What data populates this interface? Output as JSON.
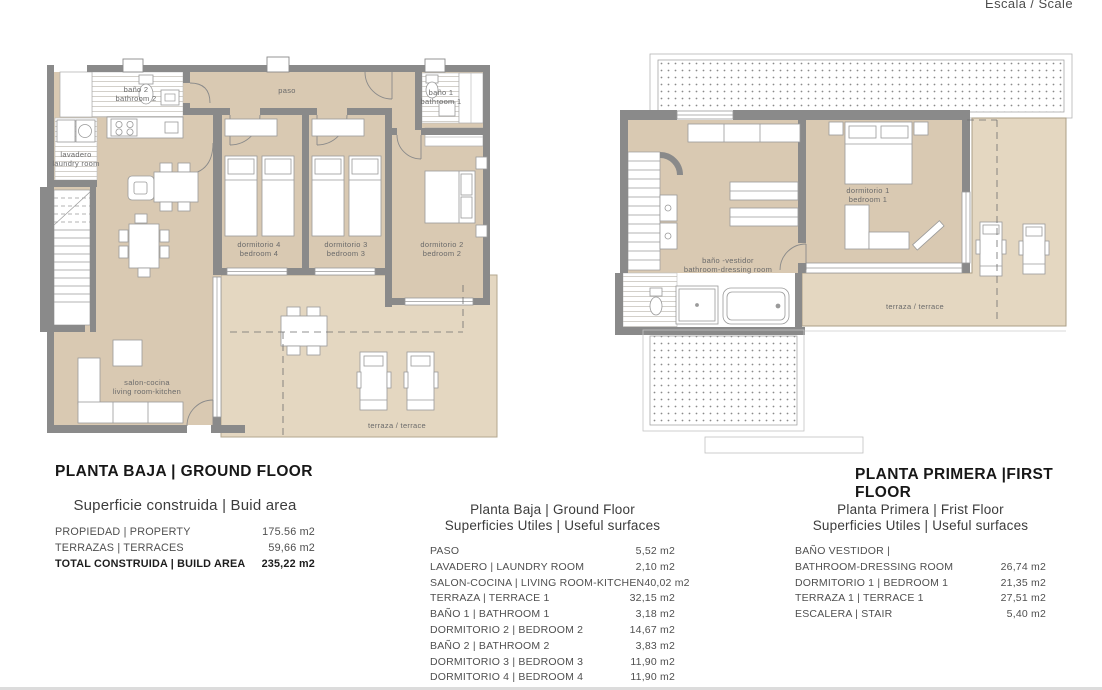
{
  "scale_note": "Escala / Scale",
  "colors": {
    "wall": "#8a8a8a",
    "floor": "#d9c9b2",
    "terrace": "#e4d7c1"
  },
  "plans": {
    "ground": {
      "title": "PLANTA BAJA | GROUND FLOOR",
      "labels": {
        "bano2_1": "baño 2",
        "bano2_2": "bathroom 2",
        "lavadero_1": "lavadero",
        "lavadero_2": "laundry room",
        "paso": "paso",
        "bano1_1": "baño 1",
        "bano1_2": "bathroom 1",
        "dorm4_1": "dormitorio 4",
        "dorm4_2": "bedroom 4",
        "dorm3_1": "dormitorio 3",
        "dorm3_2": "bedroom 3",
        "dorm2_1": "dormitorio 2",
        "dorm2_2": "bedroom 2",
        "salon_1": "salon-cocina",
        "salon_2": "living room-kitchen",
        "terraza": "terraza / terrace"
      }
    },
    "first": {
      "title": "PLANTA PRIMERA |FIRST FLOOR",
      "labels": {
        "banov_1": "baño -vestidor",
        "banov_2": "bathroom-dressing room",
        "dorm1_1": "dormitorio 1",
        "dorm1_2": "bedroom 1",
        "terraza": "terraza / terrace"
      }
    }
  },
  "tables": {
    "area": {
      "title": "Superficie construida | Buid area",
      "rows": [
        {
          "label": "PROPIEDAD | PROPERTY",
          "value": "175.56 m2"
        },
        {
          "label": "TERRAZAS | TERRACES",
          "value": "59,66 m2"
        },
        {
          "label": "TOTAL CONSTRUIDA | BUILD AREA",
          "value": "235,22 m2"
        }
      ]
    },
    "ground": {
      "title_1": "Planta Baja | Ground Floor",
      "title_2": "Superficies Utiles | Useful surfaces",
      "rows": [
        {
          "label": "PASO",
          "value": "5,52 m2"
        },
        {
          "label": "LAVADERO | LAUNDRY ROOM",
          "value": "2,10 m2"
        },
        {
          "label": "SALON-COCINA | LIVING ROOM-KITCHEN",
          "value": "40,02 m2"
        },
        {
          "label": "TERRAZA | TERRACE 1",
          "value": "32,15 m2"
        },
        {
          "label": "BAÑO 1 | BATHROOM 1",
          "value": "3,18 m2"
        },
        {
          "label": "DORMITORIO 2 | BEDROOM 2",
          "value": "14,67 m2"
        },
        {
          "label": "BAÑO 2 | BATHROOM 2",
          "value": "3,83 m2"
        },
        {
          "label": "DORMITORIO 3 | BEDROOM 3",
          "value": "11,90 m2"
        },
        {
          "label": "DORMITORIO 4 | BEDROOM 4",
          "value": "11,90 m2"
        }
      ]
    },
    "first": {
      "title_1": "Planta Primera | Frist Floor",
      "title_2": "Superficies Utiles | Useful surfaces",
      "rows": [
        {
          "label": "BAÑO VESTIDOR |",
          "value": ""
        },
        {
          "label": "BATHROOM-DRESSING ROOM",
          "value": "26,74 m2"
        },
        {
          "label": "DORMITORIO 1 | BEDROOM 1",
          "value": "21,35 m2"
        },
        {
          "label": "TERRAZA 1 | TERRACE 1",
          "value": "27,51 m2"
        },
        {
          "label": "ESCALERA | STAIR",
          "value": "5,40 m2"
        }
      ]
    }
  }
}
